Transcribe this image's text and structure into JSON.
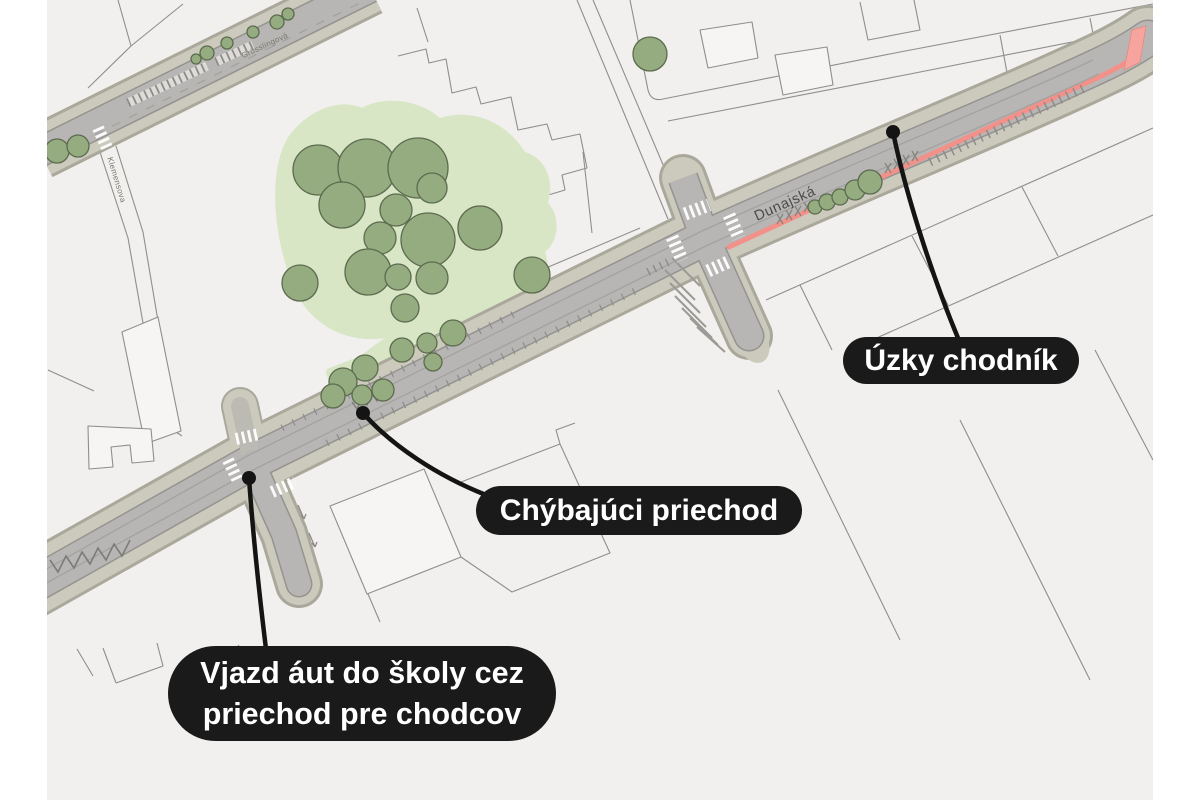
{
  "page": {
    "background": "#ffffff",
    "map_background": "#f1f0ee"
  },
  "map": {
    "streets": {
      "main_label": "Dunajská",
      "parallel_label": "Grösslingová",
      "side_label": "Klemensova"
    },
    "colors": {
      "highlight_red": "#f2918a",
      "highlight_red_fill": "#f5a59e",
      "tree_green": "#94ac80",
      "vegetation_light_green": "#d8e6c6",
      "road_gray": "#b6b5b3",
      "sidewalk_beige": "#cbcabd"
    }
  },
  "annotations": {
    "bubble_bg": "#1a1a1a",
    "bubble_text_color": "#ffffff",
    "narrow_sidewalk": {
      "label": "Úzky chodník"
    },
    "missing_crossing": {
      "label": "Chýbajúci priechod"
    },
    "school_entry": {
      "line1": "Vjazd áut do školy cez",
      "line2": "priechod pre chodcov"
    }
  }
}
